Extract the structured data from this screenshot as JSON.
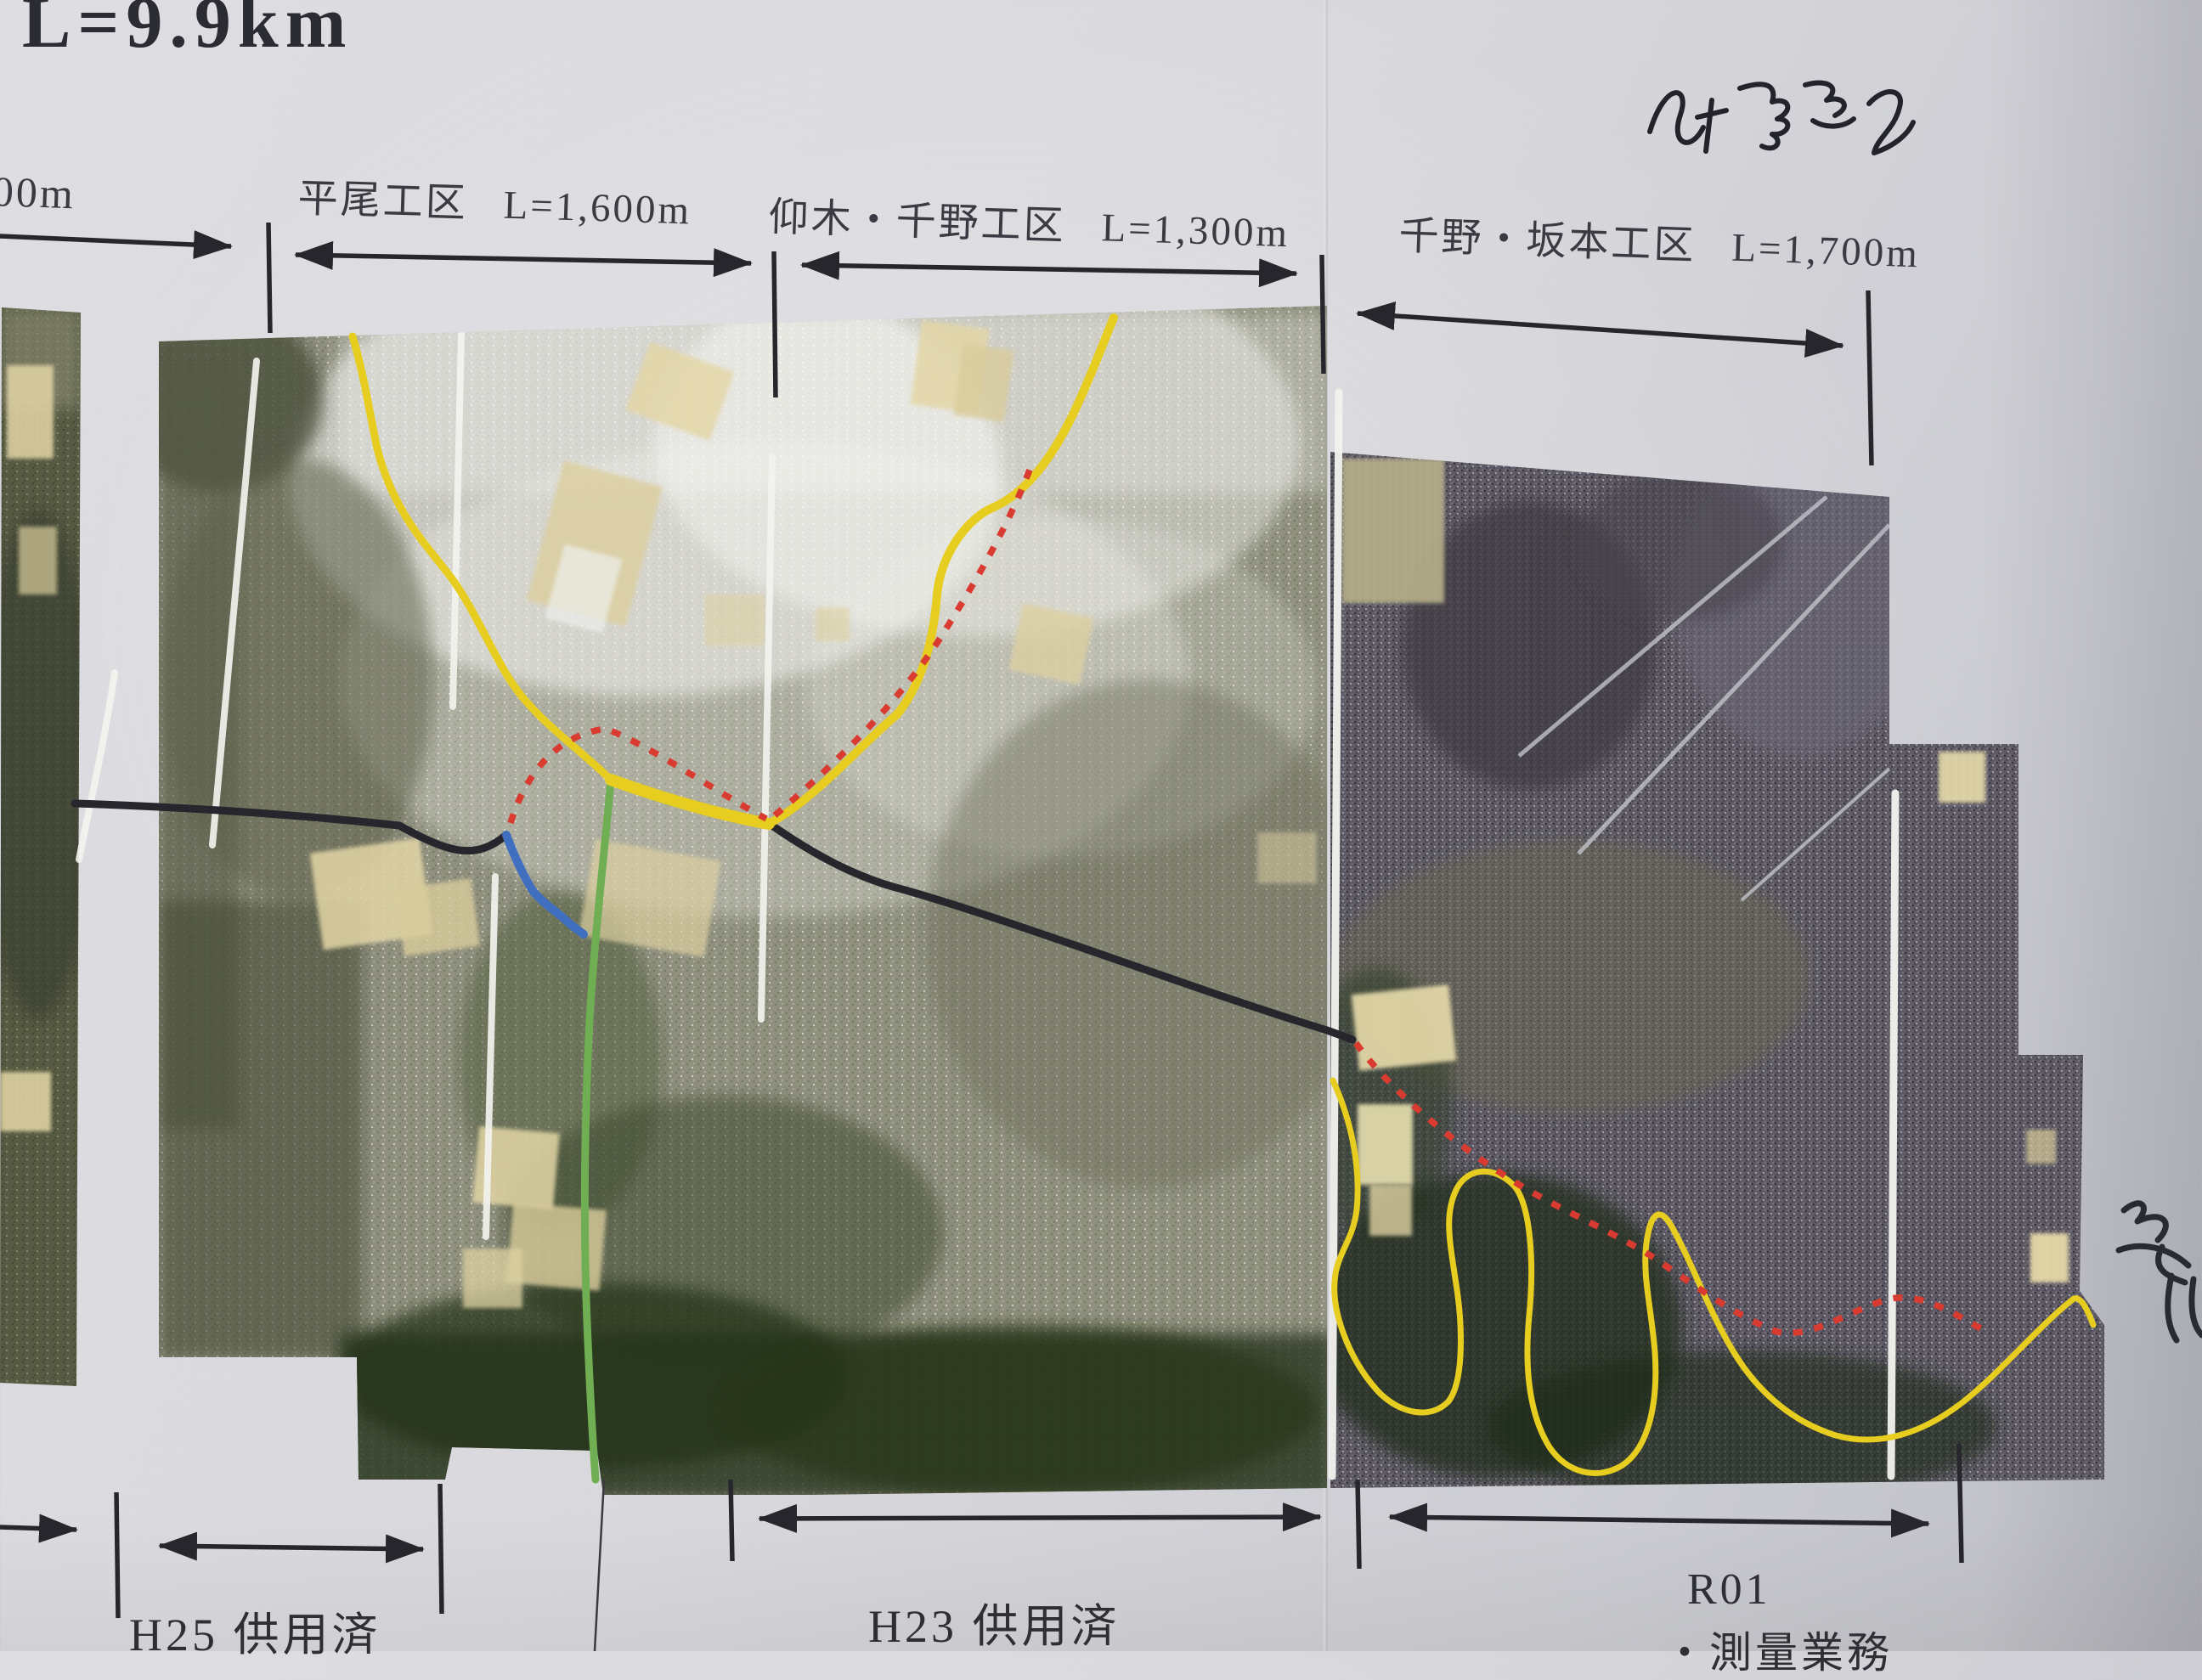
{
  "title": {
    "total_length_partial": "L=9.9km"
  },
  "top_labels": {
    "left_cutoff_length": "00m",
    "sections": [
      {
        "name": "平尾工区",
        "length": "L=1,600m"
      },
      {
        "name": "仰木・千野工区",
        "length": "L=1,300m"
      },
      {
        "name": "千野・坂本工区",
        "length": "L=1,700m"
      }
    ]
  },
  "bottom_labels": {
    "h25": "H25 供用済",
    "h23": "H23 供用済",
    "r01_line1": "R01",
    "r01_line2": "・測量業務"
  },
  "legend_colors": {
    "yellow_route": "#e6cd1f",
    "green_route": "#6fae52",
    "blue_route": "#3f6fbe",
    "black_route": "#26262c",
    "red_dotted_route": "#d93b30",
    "white_section_line": "#f3f3ef",
    "arrow_ink": "#26262c"
  }
}
